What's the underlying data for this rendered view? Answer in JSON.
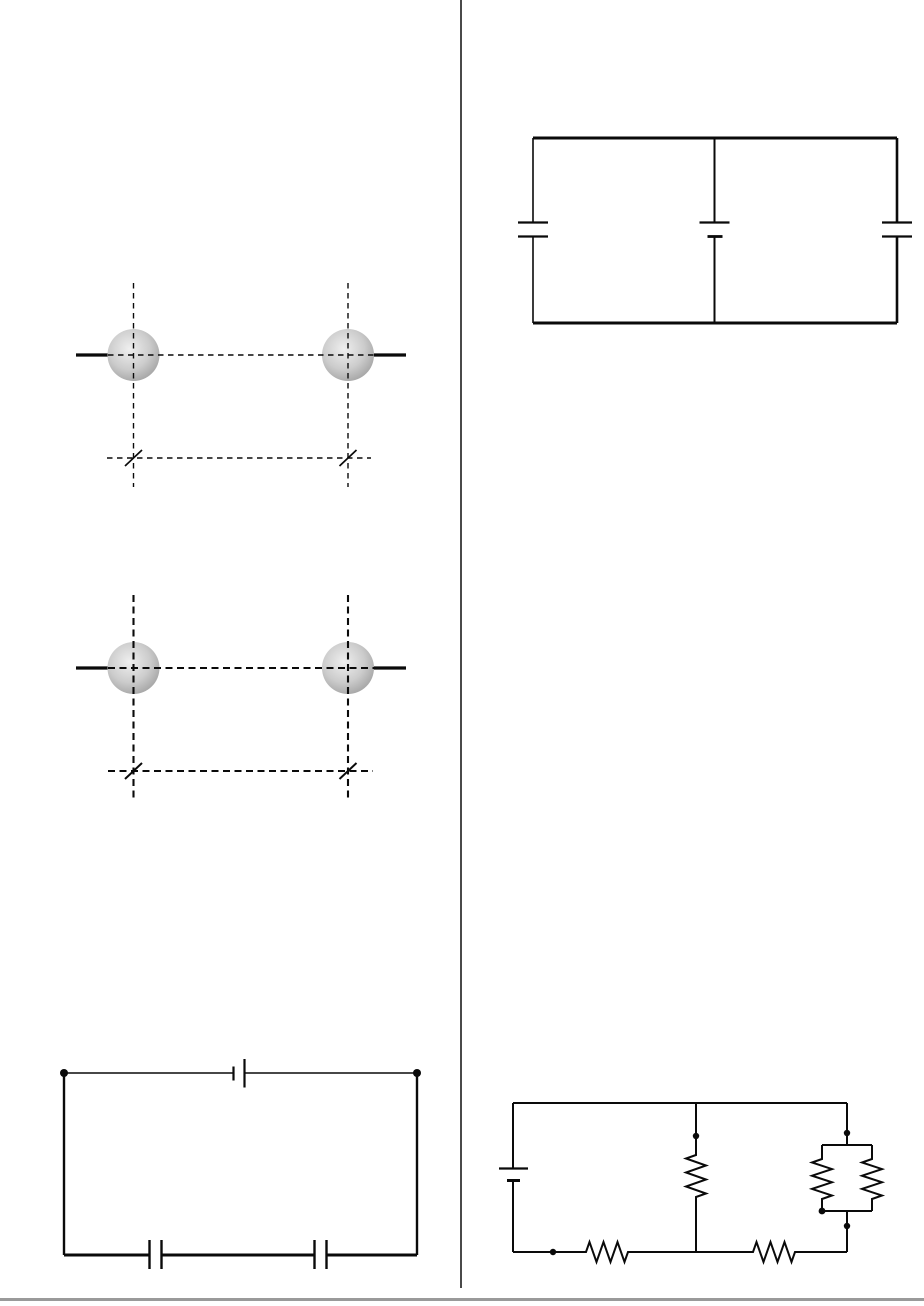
{
  "page": {
    "kind": "textbook-diagram-page",
    "text_content": "",
    "columns": 2
  },
  "appearance": {
    "page_bg": "#ffffff",
    "ink": "#0a0a0a",
    "divider_gray": "#4a4a4a",
    "footer_gray": "#9a9a9a",
    "sphere_highlight": "#efefef",
    "sphere_mid": "#cccccc",
    "sphere_edge": "#9c9c9c"
  },
  "figures": {
    "spheres_fine": {
      "label": "two shaded spheres on horizontal rods with fine dashed axes and slashed baseline",
      "sphere_count": 2,
      "tick_slash_count": 2
    },
    "spheres_heavy": {
      "label": "two shaded spheres on horizontal rods with heavy dashed axes and slashed baseline",
      "sphere_count": 2,
      "tick_slash_count": 2
    },
    "capacitor_network": {
      "label": "two-loop circuit: battery in middle branch, capacitor in left branch, capacitor in right branch",
      "batteries": 1,
      "capacitors": 2
    },
    "battery_two_capacitors": {
      "label": "single-loop circuit: battery on top wire between two terminal dots, two capacitors in series on bottom wire",
      "batteries": 1,
      "capacitors": 2,
      "terminal_dots": 2
    },
    "resistor_network": {
      "label": "circuit: battery on left, two series resistors on bottom wire, one resistor in middle branch, two parallel resistors in right branch",
      "batteries": 1,
      "resistors": 5,
      "junction_dots": 5
    }
  }
}
